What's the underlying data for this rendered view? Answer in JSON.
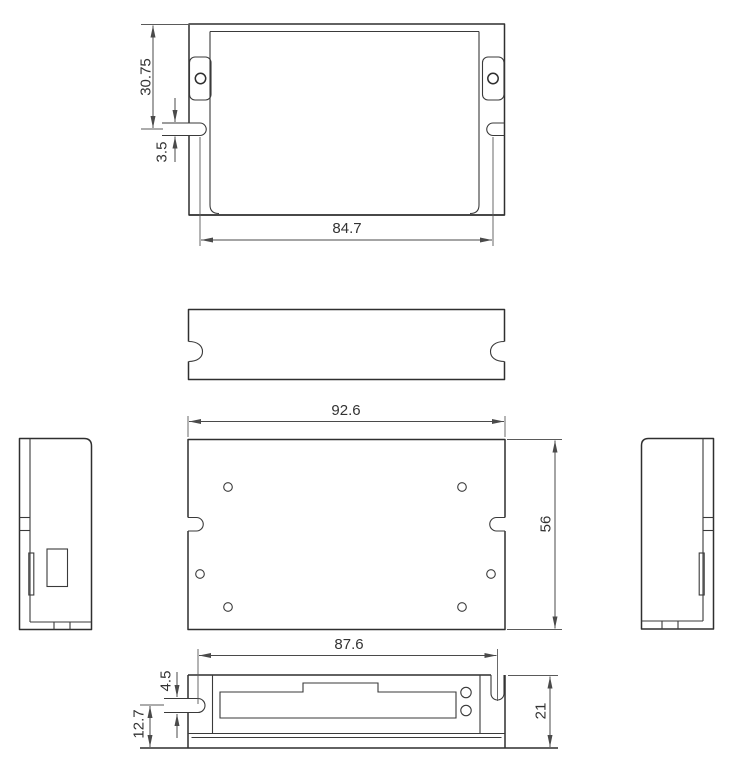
{
  "colors": {
    "background": "#ffffff",
    "outline": "#2f2f2f",
    "dimension_lines": "#4a4a4a",
    "dimension_text": "#333333"
  },
  "dimensions": {
    "top_view": {
      "flange_to_slot": "30.75",
      "slot_width": "3.5",
      "slot_span": "84.7"
    },
    "front_view": {
      "width": "92.6",
      "height": "56"
    },
    "bottom_view": {
      "slot_span": "87.6",
      "slot_width": "4.5",
      "slot_center_to_base": "12.7",
      "height": "21"
    }
  }
}
